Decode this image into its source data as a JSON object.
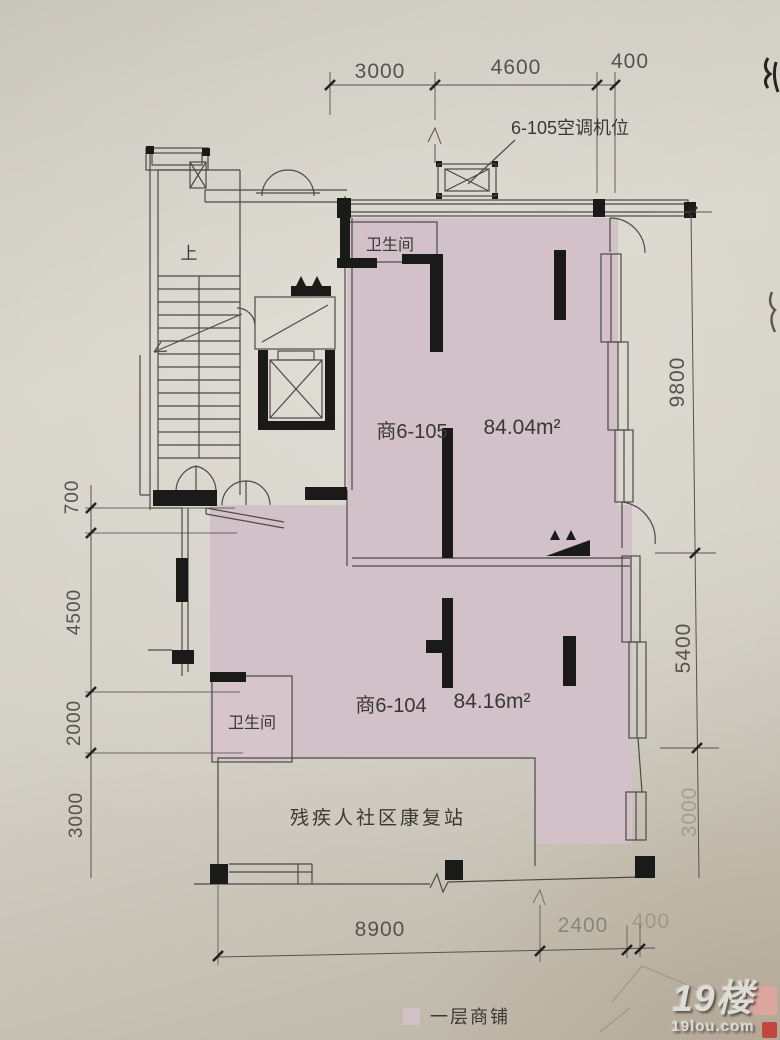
{
  "callouts": {
    "ac_unit": "6-105空调机位",
    "stair_up": "上"
  },
  "rooms": {
    "shop105": {
      "name": "商6-105",
      "area": "84.04m²",
      "bathroom": "卫生间"
    },
    "shop104": {
      "name": "商6-104",
      "area": "84.16m²",
      "bathroom": "卫生间"
    },
    "rehab": {
      "name": "残疾人社区康复站"
    }
  },
  "dimensions": {
    "top": [
      "3000",
      "4600",
      "400"
    ],
    "right": [
      "9800",
      "5400",
      "3000"
    ],
    "left": [
      "700",
      "4500",
      "2000",
      "3000"
    ],
    "bottom": [
      "8900",
      "2400",
      "400"
    ]
  },
  "legend": {
    "label": "一层商铺",
    "swatch_color": "#d2c1c8"
  },
  "watermark": {
    "title": "19楼",
    "subtitle": "19lou.com"
  },
  "colors": {
    "room_fill": "#d2c1c8",
    "wall": "#1a1a19",
    "line": "#4b4a45",
    "dim": "#55534d",
    "paper": "#cfccc2"
  }
}
